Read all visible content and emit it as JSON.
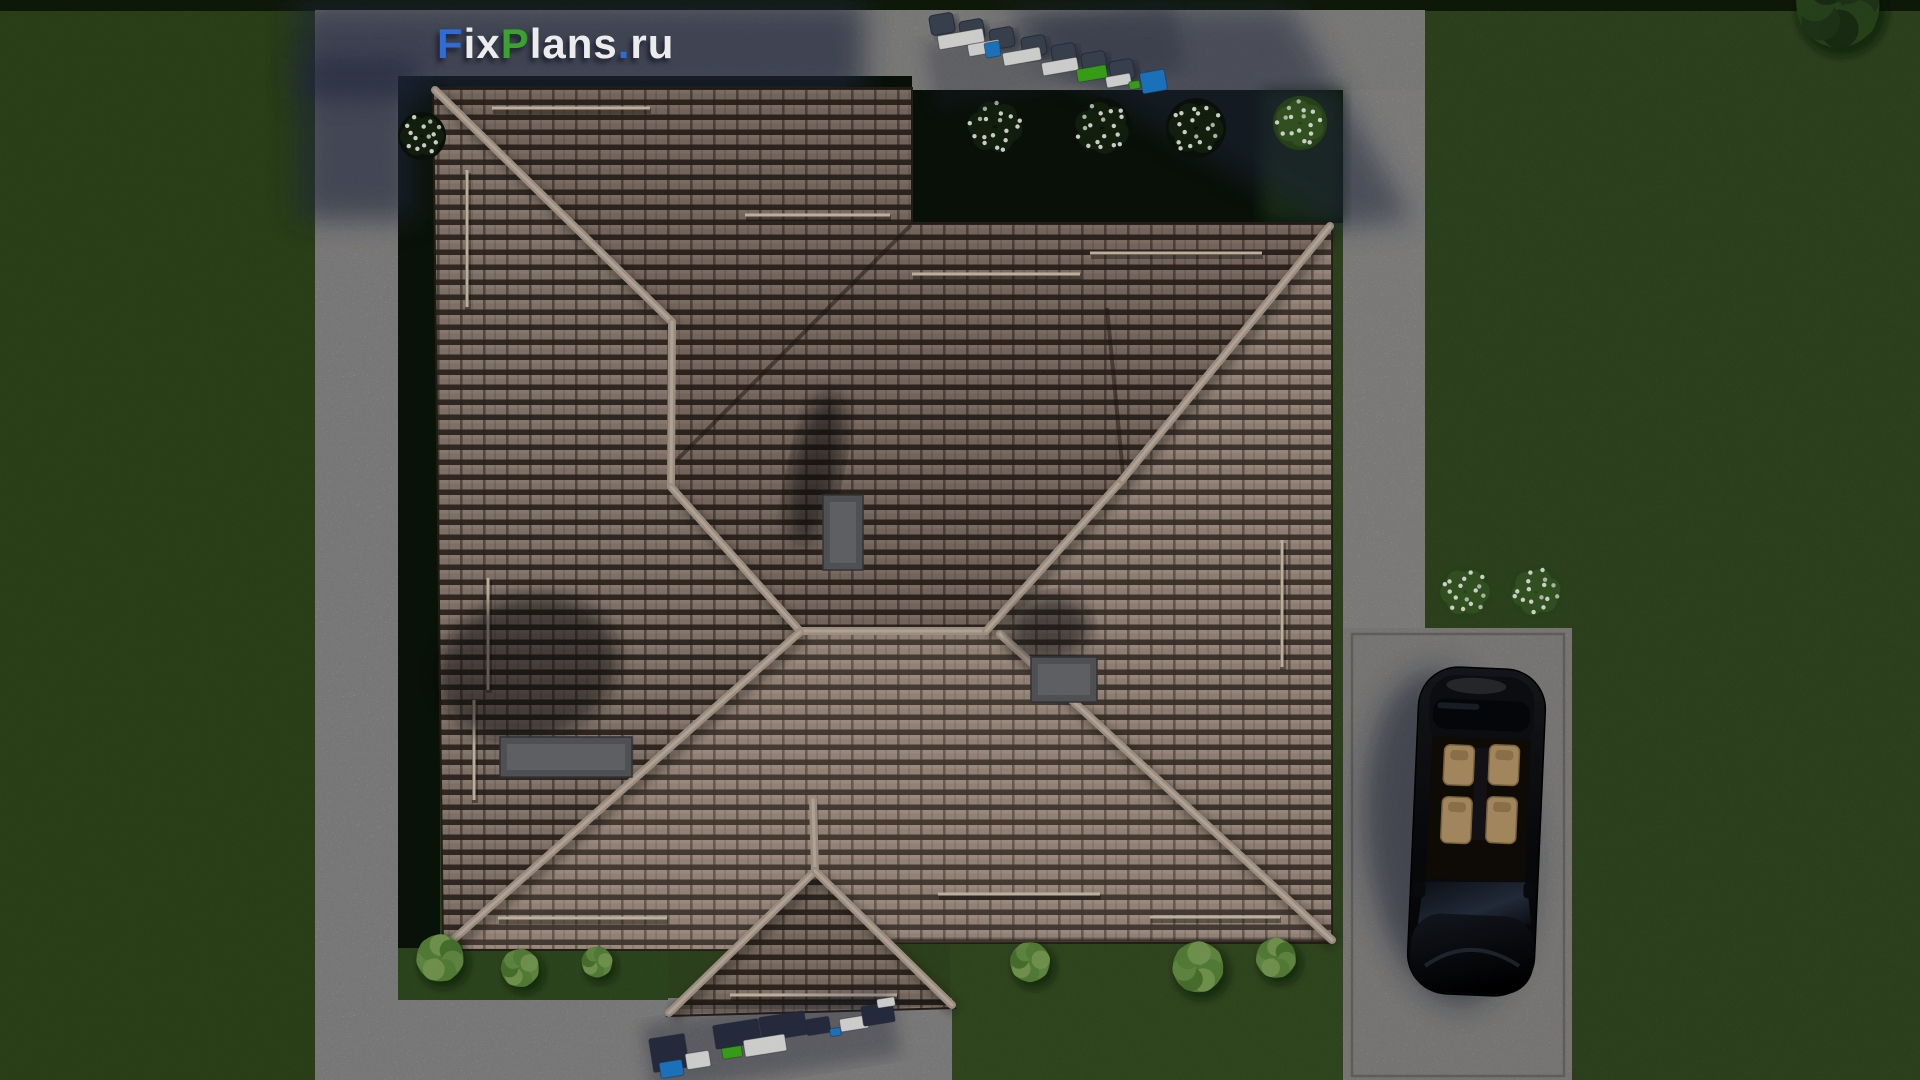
{
  "logo": {
    "segments": [
      {
        "text": "F",
        "color": "#2f6cd8"
      },
      {
        "text": "ix",
        "color": "#ececec"
      },
      {
        "text": "P",
        "color": "#3aa32e"
      },
      {
        "text": "lans",
        "color": "#ececec"
      },
      {
        "text": ".",
        "color": "#2f6cd8"
      },
      {
        "text": "ru",
        "color": "#ececec"
      }
    ],
    "full_text": "FixPlans.ru"
  },
  "palette": {
    "grass": "#4a6c31",
    "grass_left": "#466829",
    "grass_right": "#4a6d30",
    "grass_bottom": "#4f7433",
    "grass_top_strip": "#1a2a11",
    "bed_dark": "#0f1d10",
    "bed_lit": "#3f6629",
    "concrete": "#cecdcb",
    "concrete_top": "#cbcac8",
    "concrete_right": "#d0cfcd",
    "driveway": "#c7c6c3",
    "driveway_border": "#a09c97",
    "roof_tile": "#9b897d",
    "roof_gap": "#241c15",
    "ridge": "#b2a193",
    "chimney": "#5b5c60",
    "shadow_blue": "#232a44",
    "car_body": "#0b0c10",
    "car_seat": "#b8986a",
    "furn_white": "#e9e9e7",
    "furn_blue": "#1e80d4",
    "furn_green": "#3eb31a",
    "furn_navy": "#2a3145",
    "furn_chair": "#3f4757"
  },
  "scene": {
    "lawns": [
      {
        "n": "lawn-left",
        "x": 0,
        "y": 8,
        "w": 315,
        "h": 1072,
        "f": "#466829"
      },
      {
        "n": "lawn-right-upper",
        "x": 1425,
        "y": 8,
        "w": 495,
        "h": 660,
        "f": "#4a6d30"
      },
      {
        "n": "lawn-right-lower",
        "x": 1564,
        "y": 628,
        "w": 356,
        "h": 452,
        "f": "#4a6d30"
      },
      {
        "n": "lawn-bottom-right",
        "x": 950,
        "y": 938,
        "w": 405,
        "h": 142,
        "f": "#4f7433"
      },
      {
        "n": "lawn-top-strip",
        "x": 0,
        "y": 0,
        "w": 1920,
        "h": 11,
        "f": "#1a2a11"
      }
    ],
    "paths": [
      {
        "n": "path-top",
        "x": 315,
        "y": 10,
        "w": 1110,
        "h": 80,
        "f": "#cbcac8"
      },
      {
        "n": "path-left",
        "x": 315,
        "y": 10,
        "w": 85,
        "h": 990,
        "f": "#cdccca"
      },
      {
        "n": "path-bottom",
        "x": 315,
        "y": 998,
        "w": 637,
        "h": 82,
        "f": "#cdccca"
      },
      {
        "n": "path-right",
        "x": 1343,
        "y": 90,
        "w": 82,
        "h": 540,
        "f": "#d0cfcd"
      }
    ],
    "driveway": {
      "n": "driveway",
      "x": 1343,
      "y": 628,
      "w": 229,
      "h": 452,
      "f": "#c7c6c3",
      "bx": 1352,
      "by": 634,
      "bw": 212,
      "bh": 442,
      "border": "#a09c97"
    },
    "beds": [
      {
        "n": "bed-top",
        "x": 420,
        "y": 76,
        "w": 492,
        "h": 14,
        "f": "#0f1d10"
      },
      {
        "n": "bed-left",
        "x": 398,
        "y": 76,
        "w": 42,
        "h": 876,
        "f": "#11200f"
      },
      {
        "n": "bed-notch",
        "x": 912,
        "y": 90,
        "w": 431,
        "h": 133,
        "f": "#0f1d10",
        "lit_from": 1262,
        "lit": "#2e5122"
      },
      {
        "n": "bed-bottom-left",
        "x": 398,
        "y": 948,
        "w": 270,
        "h": 52,
        "f": "#4a7230"
      }
    ],
    "concrete_shadows": [
      {
        "n": "house-shadow-topleft",
        "type": "rect",
        "x": 296,
        "y": 2,
        "w": 568,
        "h": 96,
        "o": 0.62
      },
      {
        "n": "house-shadow-leftpath",
        "type": "rect",
        "x": 298,
        "y": 58,
        "w": 118,
        "h": 162,
        "o": 0.58
      },
      {
        "n": "tree-shadow-topright",
        "type": "poly",
        "pts": "1002,6 1290,6 1412,220 1332,228 1060,70",
        "o": 0.5
      }
    ],
    "roof": {
      "outline": "433,88 912,88 912,223 1332,223 1332,943 887,943 955,1008 668,1016 735,950 443,950",
      "faces": [
        {
          "n": "roof-face-north",
          "pts": "433,88 912,88 912,223 1332,223 1122,480 986,631 800,631 671,487 672,322",
          "f": "rgba(20,13,9,0.18)"
        },
        {
          "n": "roof-face-west",
          "pts": "433,88 672,322 671,487 800,631 446,946 443,950",
          "f": "rgba(18,12,8,0.08)"
        },
        {
          "n": "roof-face-south",
          "pts": "446,948 800,632 1000,632 1333,941 887,943 815,873 735,950",
          "f": "rgba(255,236,214,0.10)"
        },
        {
          "n": "roof-face-east",
          "pts": "1122,480 1332,226 1332,941 1004,634 986,631",
          "f": "rgba(255,238,218,0.06)"
        },
        {
          "n": "roof-face-gable",
          "pts": "815,873 668,1014 953,1006",
          "f": "rgba(22,15,10,0.15)"
        }
      ],
      "valleys": [
        [
          911,
          225,
          676,
          461
        ],
        [
          1107,
          308,
          1123,
          474
        ]
      ],
      "eave_shadow_lines": [
        [
          436,
          97,
          910,
          97
        ],
        [
          915,
          232,
          1330,
          232
        ],
        [
          447,
          942,
          730,
          942
        ],
        [
          890,
          940,
          1330,
          938
        ],
        [
          672,
          1008,
          950,
          1000
        ]
      ],
      "ridges": [
        [
          435,
          90,
          672,
          322
        ],
        [
          672,
          322,
          671,
          487
        ],
        [
          671,
          487,
          800,
          631
        ],
        [
          800,
          631,
          986,
          631
        ],
        [
          986,
          631,
          1122,
          480
        ],
        [
          1122,
          480,
          1330,
          226
        ],
        [
          446,
          946,
          800,
          632
        ],
        [
          1000,
          634,
          1332,
          940
        ],
        [
          813,
          800,
          815,
          871
        ],
        [
          815,
          871,
          669,
          1013
        ],
        [
          815,
          871,
          952,
          1005
        ]
      ],
      "snow_guards": [
        [
          492,
          108,
          650,
          108
        ],
        [
          745,
          215,
          890,
          215
        ],
        [
          467,
          170,
          467,
          307
        ],
        [
          488,
          578,
          488,
          690
        ],
        [
          474,
          700,
          474,
          800
        ],
        [
          1090,
          253,
          1262,
          253
        ],
        [
          912,
          274,
          1080,
          274
        ],
        [
          1282,
          540,
          1282,
          667
        ],
        [
          498,
          918,
          667,
          918
        ],
        [
          938,
          894,
          1100,
          894
        ],
        [
          1150,
          917,
          1280,
          917
        ],
        [
          730,
          995,
          897,
          995
        ]
      ],
      "chimney_shadows": [
        {
          "cx": 528,
          "cy": 668,
          "rx": 92,
          "ry": 72,
          "rot": -15,
          "o": 0.5
        },
        {
          "cx": 816,
          "cy": 468,
          "rx": 24,
          "ry": 78,
          "rot": 12,
          "o": 0.55
        },
        {
          "cx": 1050,
          "cy": 628,
          "rx": 40,
          "ry": 32,
          "rot": -10,
          "o": 0.5
        }
      ],
      "chimneys": [
        {
          "n": "roof-hatch",
          "x": 500,
          "y": 737,
          "w": 132,
          "h": 40
        },
        {
          "n": "chimney-upper",
          "x": 823,
          "y": 495,
          "w": 40,
          "h": 75
        },
        {
          "n": "chimney-lower",
          "x": 1031,
          "y": 657,
          "w": 66,
          "h": 45
        }
      ]
    },
    "furniture": {
      "top_row": {
        "rot": -10,
        "shadow": {
          "x": 928,
          "y": 20,
          "w": 252,
          "h": 72,
          "o": 0.25
        },
        "chairs": [
          [
            930,
            14,
            24,
            20
          ],
          [
            960,
            20,
            24,
            20
          ],
          [
            990,
            28,
            24,
            20
          ],
          [
            1022,
            36,
            24,
            20
          ],
          [
            1052,
            44,
            24,
            20
          ],
          [
            1082,
            52,
            24,
            20
          ],
          [
            1110,
            60,
            24,
            20
          ]
        ],
        "items": [
          {
            "x": 938,
            "y": 32,
            "w": 46,
            "h": 14,
            "c": "white"
          },
          {
            "x": 968,
            "y": 42,
            "w": 32,
            "h": 12,
            "c": "white"
          },
          {
            "x": 985,
            "y": 42,
            "w": 15,
            "h": 15,
            "c": "blue"
          },
          {
            "x": 1003,
            "y": 50,
            "w": 38,
            "h": 13,
            "c": "white"
          },
          {
            "x": 1042,
            "y": 60,
            "w": 36,
            "h": 13,
            "c": "white"
          },
          {
            "x": 1077,
            "y": 67,
            "w": 30,
            "h": 13,
            "c": "green"
          },
          {
            "x": 1106,
            "y": 75,
            "w": 25,
            "h": 11,
            "c": "white"
          },
          {
            "x": 1129,
            "y": 81,
            "w": 11,
            "h": 8,
            "c": "green"
          },
          {
            "x": 1141,
            "y": 71,
            "w": 25,
            "h": 21,
            "c": "blue"
          }
        ]
      },
      "bottom_row": {
        "rot": -9,
        "shadow": {
          "x": 645,
          "y": 1005,
          "w": 252,
          "h": 70,
          "o": 0.3
        },
        "chairs": [],
        "items": [
          {
            "x": 651,
            "y": 1036,
            "w": 36,
            "h": 34,
            "c": "navy"
          },
          {
            "x": 660,
            "y": 1061,
            "w": 23,
            "h": 16,
            "c": "blue"
          },
          {
            "x": 686,
            "y": 1052,
            "w": 24,
            "h": 16,
            "c": "white"
          },
          {
            "x": 722,
            "y": 1046,
            "w": 20,
            "h": 12,
            "c": "green"
          },
          {
            "x": 714,
            "y": 1022,
            "w": 46,
            "h": 24,
            "c": "navy"
          },
          {
            "x": 760,
            "y": 1014,
            "w": 46,
            "h": 24,
            "c": "navy"
          },
          {
            "x": 744,
            "y": 1037,
            "w": 42,
            "h": 17,
            "c": "white"
          },
          {
            "x": 806,
            "y": 1018,
            "w": 24,
            "h": 16,
            "c": "navy"
          },
          {
            "x": 830,
            "y": 1028,
            "w": 11,
            "h": 8,
            "c": "blue"
          },
          {
            "x": 840,
            "y": 1017,
            "w": 28,
            "h": 13,
            "c": "white"
          },
          {
            "x": 862,
            "y": 1004,
            "w": 32,
            "h": 20,
            "c": "navy"
          },
          {
            "x": 877,
            "y": 998,
            "w": 18,
            "h": 9,
            "c": "white"
          }
        ]
      }
    },
    "flower_bushes": [
      {
        "x": 422,
        "y": 136,
        "r": 24,
        "lit": false
      },
      {
        "x": 995,
        "y": 127,
        "r": 30,
        "lit": false
      },
      {
        "x": 1102,
        "y": 128,
        "r": 30,
        "lit": false
      },
      {
        "x": 1196,
        "y": 128,
        "r": 30,
        "lit": false
      },
      {
        "x": 1300,
        "y": 123,
        "r": 27,
        "lit": true
      },
      {
        "x": 1465,
        "y": 592,
        "r": 27,
        "lit": true
      },
      {
        "x": 1536,
        "y": 592,
        "r": 27,
        "lit": true
      }
    ],
    "green_bushes": [
      {
        "x": 440,
        "y": 958,
        "r": 26
      },
      {
        "x": 520,
        "y": 968,
        "r": 21
      },
      {
        "x": 597,
        "y": 962,
        "r": 17
      },
      {
        "x": 1030,
        "y": 962,
        "r": 22
      },
      {
        "x": 1198,
        "y": 967,
        "r": 28
      },
      {
        "x": 1276,
        "y": 958,
        "r": 22
      },
      {
        "x": 1838,
        "y": 6,
        "r": 46,
        "dark": true
      }
    ],
    "car": {
      "x": 1413,
      "y": 668,
      "w": 127,
      "h": 327,
      "rot": 2.5,
      "shadow": {
        "cx": 1448,
        "cy": 838,
        "rx": 82,
        "ry": 168,
        "rot": -6,
        "o": 0.5
      }
    }
  }
}
